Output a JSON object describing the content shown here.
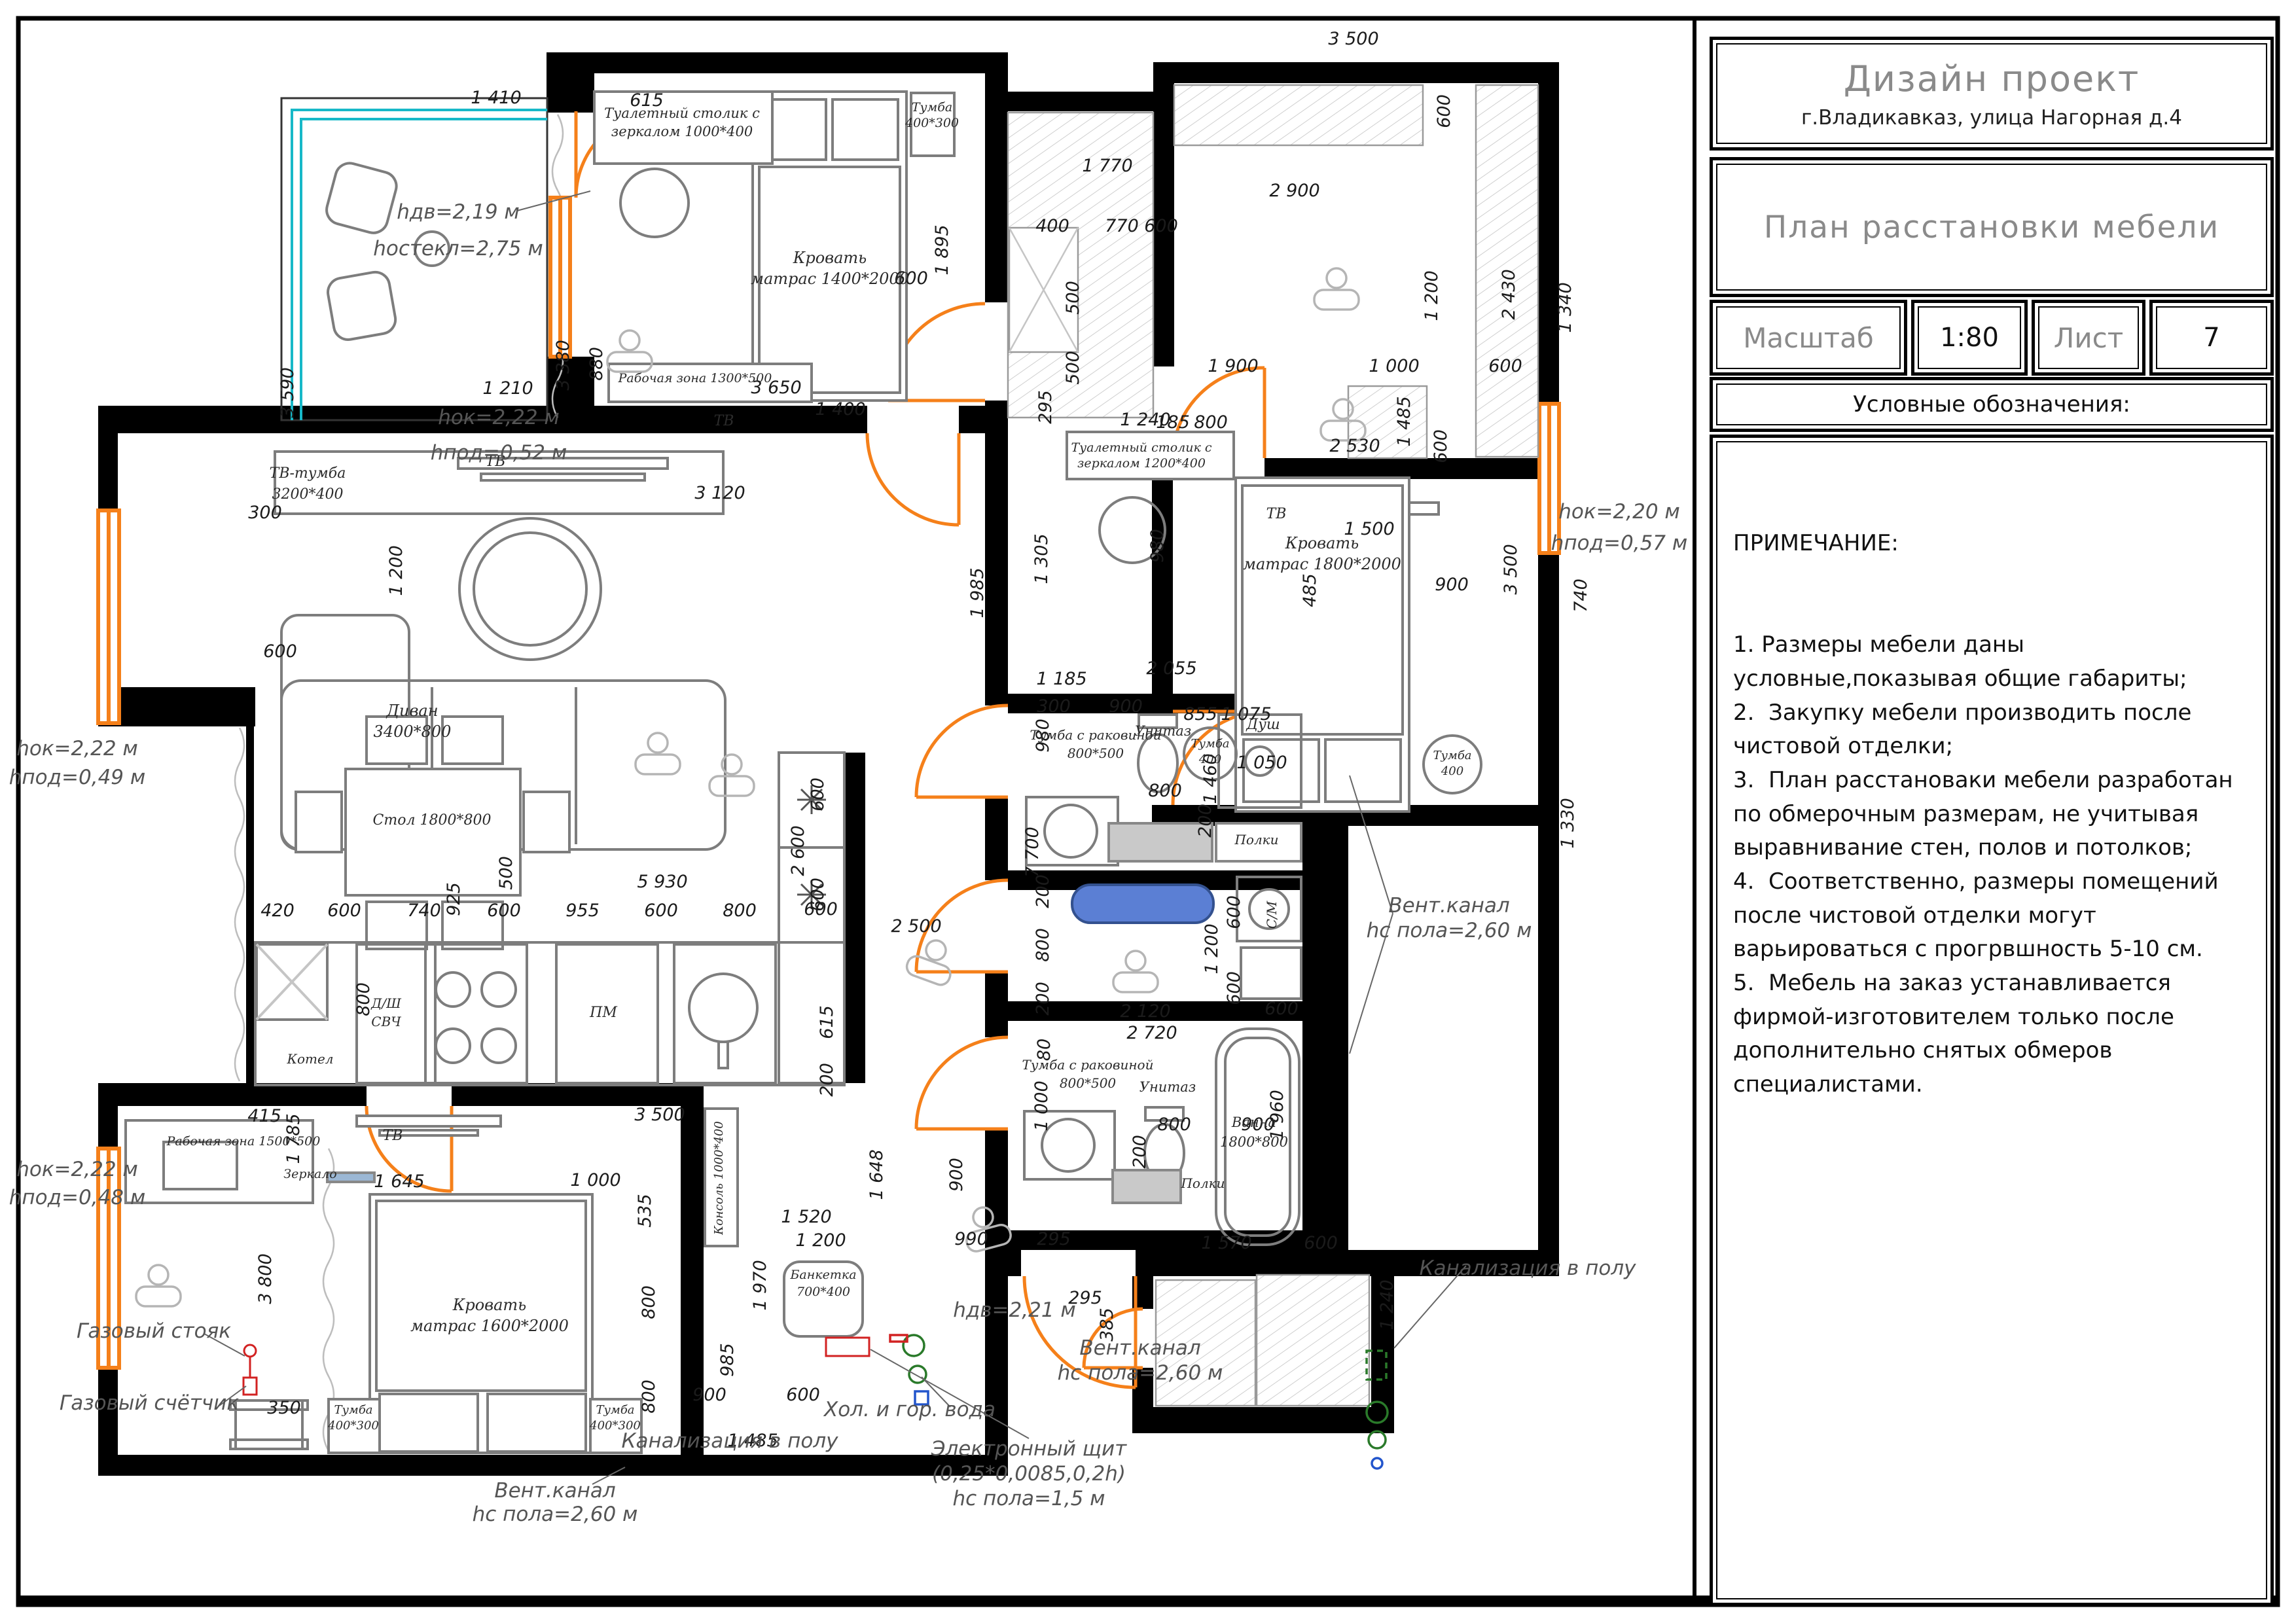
{
  "title_block": {
    "project_title": "Дизайн проект",
    "address": "г.Владикавказ, улица Нагорная д.4",
    "drawing_title": "План расстановки мебели",
    "scale_label": "Масштаб",
    "scale_value": "1:80",
    "sheet_label": "Лист",
    "sheet_value": "7",
    "legend_label": "Условные обозначения:"
  },
  "notes": {
    "heading": "ПРИМЕЧАНИЕ:",
    "items": [
      "1. Размеры мебели даны условные,показывая общие габариты;",
      "2.  Закупку мебели производить после чистовой отделки;",
      "3.  План расстановаки мебели разработан по обмерочным размерам, не учитывая выравнивание стен, полов и потолков;",
      "4.  Соответственно, размеры помещений после чистовой отделки могут варьироваться с прогрвшность 5-10 см.",
      "5.  Мебель на заказ устанавливается фирмой-изготовителем только после дополнительно снятых обмеров специалистами."
    ]
  },
  "colors": {
    "wall": "#000000",
    "furniture": "#7d7d7d",
    "accent_orange": "#f5801a",
    "glazing_cyan": "#17b8c8",
    "ironing_blue": "#5b7fd4",
    "utility_green": "#2a7a2a",
    "utility_red": "#d22222",
    "utility_blue": "#2255cc"
  },
  "plan": {
    "dims": [
      [
        758,
        158,
        "1 410"
      ],
      [
        988,
        162,
        "615"
      ],
      [
        448,
        600,
        "3 590",
        1
      ],
      [
        869,
        558,
        "3 380",
        1
      ],
      [
        776,
        602,
        "1 210"
      ],
      [
        1448,
        382,
        "1 895",
        1
      ],
      [
        1392,
        434,
        "600"
      ],
      [
        920,
        556,
        "880",
        1
      ],
      [
        1186,
        601,
        "3 650"
      ],
      [
        1284,
        634,
        "1 400"
      ],
      [
        1692,
        262,
        "1 770"
      ],
      [
        1608,
        354,
        "400"
      ],
      [
        1714,
        354,
        "770"
      ],
      [
        1648,
        455,
        "500",
        1
      ],
      [
        1648,
        562,
        "500",
        1
      ],
      [
        1606,
        622,
        "295",
        1
      ],
      [
        1774,
        354,
        "600"
      ],
      [
        2215,
        170,
        "600",
        1
      ],
      [
        2068,
        68,
        "3 500"
      ],
      [
        1978,
        300,
        "2 900"
      ],
      [
        2196,
        452,
        "1 200",
        1
      ],
      [
        2314,
        450,
        "2 430",
        1
      ],
      [
        1884,
        568,
        "1 900"
      ],
      [
        2130,
        568,
        "1 000"
      ],
      [
        2300,
        568,
        "600"
      ],
      [
        2070,
        690,
        "2 530"
      ],
      [
        2210,
        682,
        "600",
        1
      ],
      [
        1792,
        654,
        "185"
      ],
      [
        1850,
        654,
        "800"
      ],
      [
        1777,
        834,
        "980",
        1
      ],
      [
        2092,
        817,
        "1 500"
      ],
      [
        2010,
        902,
        "485",
        1
      ],
      [
        2400,
        470,
        "1 340",
        1
      ],
      [
        2424,
        910,
        "740",
        1
      ],
      [
        2404,
        1258,
        "1 330",
        1
      ],
      [
        2154,
        644,
        "1 485",
        1
      ],
      [
        2317,
        870,
        "3 500",
        1
      ],
      [
        2218,
        902,
        "900"
      ],
      [
        1834,
        1100,
        "855"
      ],
      [
        1502,
        906,
        "1 985",
        1
      ],
      [
        1586,
        1302,
        "7 700",
        1
      ],
      [
        1600,
        854,
        "1 305",
        1
      ],
      [
        1750,
        650,
        "1 240"
      ],
      [
        1790,
        1030,
        "2 055"
      ],
      [
        1610,
        1088,
        "300"
      ],
      [
        1720,
        1088,
        "900"
      ],
      [
        1622,
        1046,
        "1 185"
      ],
      [
        1602,
        1124,
        "980",
        1
      ],
      [
        1858,
        1190,
        "1 460",
        1
      ],
      [
        1780,
        1217,
        "800"
      ],
      [
        1904,
        1100,
        "1 075"
      ],
      [
        1928,
        1174,
        "1 050"
      ],
      [
        1850,
        1254,
        "200",
        1
      ],
      [
        1602,
        1362,
        "200",
        1
      ],
      [
        1602,
        1444,
        "800",
        1
      ],
      [
        1602,
        1526,
        "200",
        1
      ],
      [
        1750,
        1554,
        "2 120"
      ],
      [
        1860,
        1450,
        "1 200",
        1
      ],
      [
        1894,
        1394,
        "600",
        1
      ],
      [
        1894,
        1510,
        "600",
        1
      ],
      [
        1958,
        1550,
        "600"
      ],
      [
        1600,
        1690,
        "1 000",
        1
      ],
      [
        1604,
        1604,
        "80",
        1
      ],
      [
        1794,
        1727,
        "800"
      ],
      [
        1922,
        1727,
        "900"
      ],
      [
        1750,
        1760,
        "200",
        1
      ],
      [
        1960,
        1704,
        "1 960",
        1
      ],
      [
        1760,
        1587,
        "2 720"
      ],
      [
        1874,
        1908,
        "1 570"
      ],
      [
        2018,
        1908,
        "600"
      ],
      [
        2128,
        1994,
        "1 240",
        1
      ],
      [
        1658,
        1992,
        "295"
      ],
      [
        1700,
        2024,
        "385",
        1
      ],
      [
        1254,
        1904,
        "1 200"
      ],
      [
        1484,
        1902,
        "990"
      ],
      [
        1610,
        1902,
        "295"
      ],
      [
        1170,
        1964,
        "1 970",
        1
      ],
      [
        1084,
        2140,
        "900"
      ],
      [
        1227,
        2140,
        "600"
      ],
      [
        1150,
        2210,
        "1 485"
      ],
      [
        1120,
        2078,
        "985",
        1
      ],
      [
        1232,
        1868,
        "1 520"
      ],
      [
        1348,
        1795,
        "1 648",
        1
      ],
      [
        1470,
        1795,
        "900",
        1
      ],
      [
        610,
        1814,
        "1 645"
      ],
      [
        910,
        1812,
        "1 000"
      ],
      [
        994,
        1850,
        "535",
        1
      ],
      [
        1000,
        1990,
        "800",
        1
      ],
      [
        1000,
        2134,
        "800",
        1
      ],
      [
        414,
        1954,
        "3 800",
        1
      ],
      [
        457,
        1740,
        "1 785",
        1
      ],
      [
        434,
        2160,
        "350"
      ],
      [
        404,
        1714,
        "415"
      ],
      [
        1008,
        1712,
        "3 500"
      ],
      [
        405,
        792,
        "300"
      ],
      [
        1100,
        762,
        "3 120"
      ],
      [
        614,
        872,
        "1 200",
        1
      ],
      [
        428,
        1004,
        "600"
      ],
      [
        782,
        1334,
        "500",
        1
      ],
      [
        1400,
        1424,
        "2 500"
      ],
      [
        702,
        1374,
        "925",
        1
      ],
      [
        1012,
        1356,
        "5 930"
      ],
      [
        424,
        1400,
        "420"
      ],
      [
        526,
        1400,
        "600"
      ],
      [
        648,
        1400,
        "740"
      ],
      [
        770,
        1400,
        "600"
      ],
      [
        890,
        1400,
        "955"
      ],
      [
        1010,
        1400,
        "600"
      ],
      [
        1130,
        1400,
        "800"
      ],
      [
        1254,
        1398,
        "600"
      ],
      [
        564,
        1527,
        "800",
        1
      ],
      [
        1258,
        1214,
        "600",
        1
      ],
      [
        1258,
        1367,
        "600",
        1
      ],
      [
        1228,
        1300,
        "2 600",
        1
      ],
      [
        1272,
        1562,
        "615",
        1
      ],
      [
        1272,
        1650,
        "200",
        1
      ]
    ],
    "labels": [
      [
        1042,
        180,
        "Туалетный столик с",
        21
      ],
      [
        1042,
        208,
        "зеркалом 1000*400",
        21
      ],
      [
        1268,
        402,
        "Кровать",
        24
      ],
      [
        1268,
        434,
        "матрас 1400*2000",
        24
      ],
      [
        1424,
        170,
        "Тумба",
        19
      ],
      [
        1424,
        194,
        "400*300",
        19
      ],
      [
        1062,
        584,
        "Рабочая зона 1300*500",
        19
      ],
      [
        1106,
        650,
        "ТВ",
        22
      ],
      [
        1950,
        792,
        "ТВ",
        22
      ],
      [
        2020,
        838,
        "Кровать",
        24
      ],
      [
        2020,
        870,
        "матрас 1800*2000",
        24
      ],
      [
        1849,
        1142,
        "Тумба",
        18
      ],
      [
        1849,
        1166,
        "400",
        18
      ],
      [
        2219,
        1160,
        "Тумба",
        18
      ],
      [
        2219,
        1184,
        "400",
        18
      ],
      [
        1674,
        1130,
        "Тумба с раковиной",
        20
      ],
      [
        1674,
        1158,
        "800*500",
        20
      ],
      [
        1777,
        1124,
        "Унитаз",
        21
      ],
      [
        1930,
        1114,
        "Душ",
        22
      ],
      [
        1920,
        1290,
        "Полки",
        20
      ],
      [
        1950,
        1398,
        "С/М",
        20,
        1
      ],
      [
        1662,
        1634,
        "Тумба с раковиной",
        20
      ],
      [
        1662,
        1662,
        "800*500",
        20
      ],
      [
        1784,
        1668,
        "Унитаз",
        21
      ],
      [
        1916,
        1722,
        "Ванна",
        21
      ],
      [
        1916,
        1752,
        "1800*800",
        21
      ],
      [
        1838,
        1815,
        "Полки",
        20
      ],
      [
        470,
        730,
        "ТВ-тумба",
        22
      ],
      [
        470,
        762,
        "3200*400",
        22
      ],
      [
        757,
        712,
        "ТВ",
        22
      ],
      [
        630,
        1094,
        "Диван",
        24
      ],
      [
        630,
        1126,
        "3400*800",
        24
      ],
      [
        660,
        1260,
        "Стол 1800*800",
        22
      ],
      [
        590,
        1540,
        "Д/Ш",
        20
      ],
      [
        590,
        1568,
        "СВЧ",
        20
      ],
      [
        474,
        1625,
        "Котел",
        20
      ],
      [
        922,
        1554,
        "ПМ",
        22
      ],
      [
        748,
        2002,
        "Кровать",
        24
      ],
      [
        748,
        2034,
        "матрас 1600*2000",
        24
      ],
      [
        540,
        2160,
        "Тумба",
        18
      ],
      [
        540,
        2184,
        "400*300",
        18
      ],
      [
        940,
        2160,
        "Тумба",
        18
      ],
      [
        940,
        2184,
        "400*300",
        18
      ],
      [
        372,
        1750,
        "Рабочая зона 1500*500",
        19
      ],
      [
        600,
        1742,
        "ТВ",
        22
      ],
      [
        474,
        1800,
        "Зеркало",
        19
      ],
      [
        1258,
        1954,
        "Банкетка",
        19
      ],
      [
        1258,
        1980,
        "700*400",
        19
      ],
      [
        1104,
        1800,
        "Консоль 1000*400",
        18,
        1
      ],
      [
        1744,
        690,
        "Туалетный столик с",
        19
      ],
      [
        1744,
        714,
        "зеркалом 1200*400",
        19
      ]
    ],
    "annotations": [
      [
        235,
        2044,
        "Газовый стояк"
      ],
      [
        228,
        2154,
        "Газовый счётчик"
      ],
      [
        848,
        2288,
        "Вент.канал"
      ],
      [
        848,
        2324,
        "hс пола=2,60 м"
      ],
      [
        1115,
        2212,
        "Канализация в полу"
      ],
      [
        2214,
        1394,
        "Вент.канал"
      ],
      [
        2214,
        1432,
        "hс пола=2,60 м"
      ],
      [
        2334,
        1948,
        "Канализация в полу"
      ],
      [
        1742,
        2070,
        "Вент.канал"
      ],
      [
        1742,
        2108,
        "hс пола=2,60 м"
      ],
      [
        1390,
        2164,
        "Хол. и гор. вода"
      ],
      [
        1572,
        2224,
        "Электронный щит"
      ],
      [
        1572,
        2262,
        "(0,25*0,0085,0,2h)"
      ],
      [
        1572,
        2300,
        "hс пола=1,5 м"
      ],
      [
        700,
        334,
        "hдв=2,19 м"
      ],
      [
        700,
        390,
        "hостекл=2,75 м"
      ],
      [
        762,
        648,
        "hок=2,22 м"
      ],
      [
        762,
        702,
        "hпод=0,52 м"
      ],
      [
        118,
        1154,
        "hок=2,22 м"
      ],
      [
        118,
        1198,
        "hпод=0,49 м"
      ],
      [
        118,
        1797,
        "hок=2,22 м"
      ],
      [
        118,
        1840,
        "hпод=0,48 м"
      ],
      [
        2474,
        792,
        "hок=2,20 м"
      ],
      [
        2474,
        840,
        "hпод=0,57 м"
      ],
      [
        1550,
        2012,
        "hдв=2,21 м"
      ]
    ]
  }
}
